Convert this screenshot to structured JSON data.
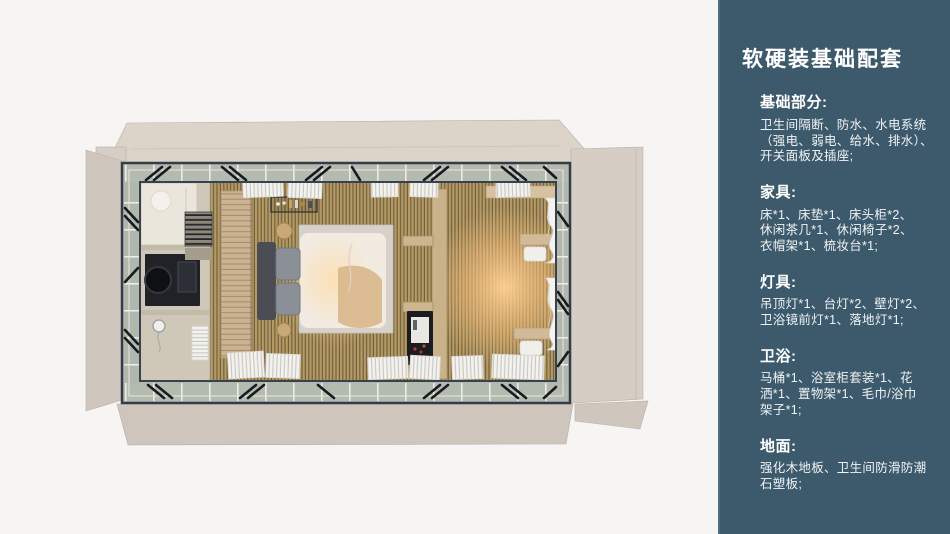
{
  "theme": {
    "accent_bg": "#3d5a6c",
    "accent_edge": "#4e6a7e",
    "text": "#f0f3f5",
    "page_bg": "#f6f5f3"
  },
  "render_palette": {
    "wood_floor": "#b89a61",
    "unfolded_panels": "#d6cdc4",
    "steel_frame": "#38424e",
    "perimeter_band": "#b3bab0",
    "warm_glow": "#ffd296"
  },
  "sidebar": {
    "title": "软硬装基础配套",
    "sections": [
      {
        "heading": "基础部分:",
        "body": "卫生间隔断、防水、水电系统\n（强电、弱电、给水、排水）、\n开关面板及插座;"
      },
      {
        "heading": "家具:",
        "body": "床*1、床垫*1、床头柜*2、\n休闲茶几*1、休闲椅子*2、\n衣帽架*1、梳妆台*1;"
      },
      {
        "heading": "灯具:",
        "body": "吊顶灯*1、台灯*2、壁灯*2、\n卫浴镜前灯*1、落地灯*1;"
      },
      {
        "heading": "卫浴:",
        "body": "马桶*1、浴室柜套装*1、花\n洒*1、置物架*1、毛巾/浴巾\n架子*1;"
      },
      {
        "heading": "地面:",
        "body": "强化木地板、卫生间防滑防潮\n石塑板;"
      }
    ]
  }
}
